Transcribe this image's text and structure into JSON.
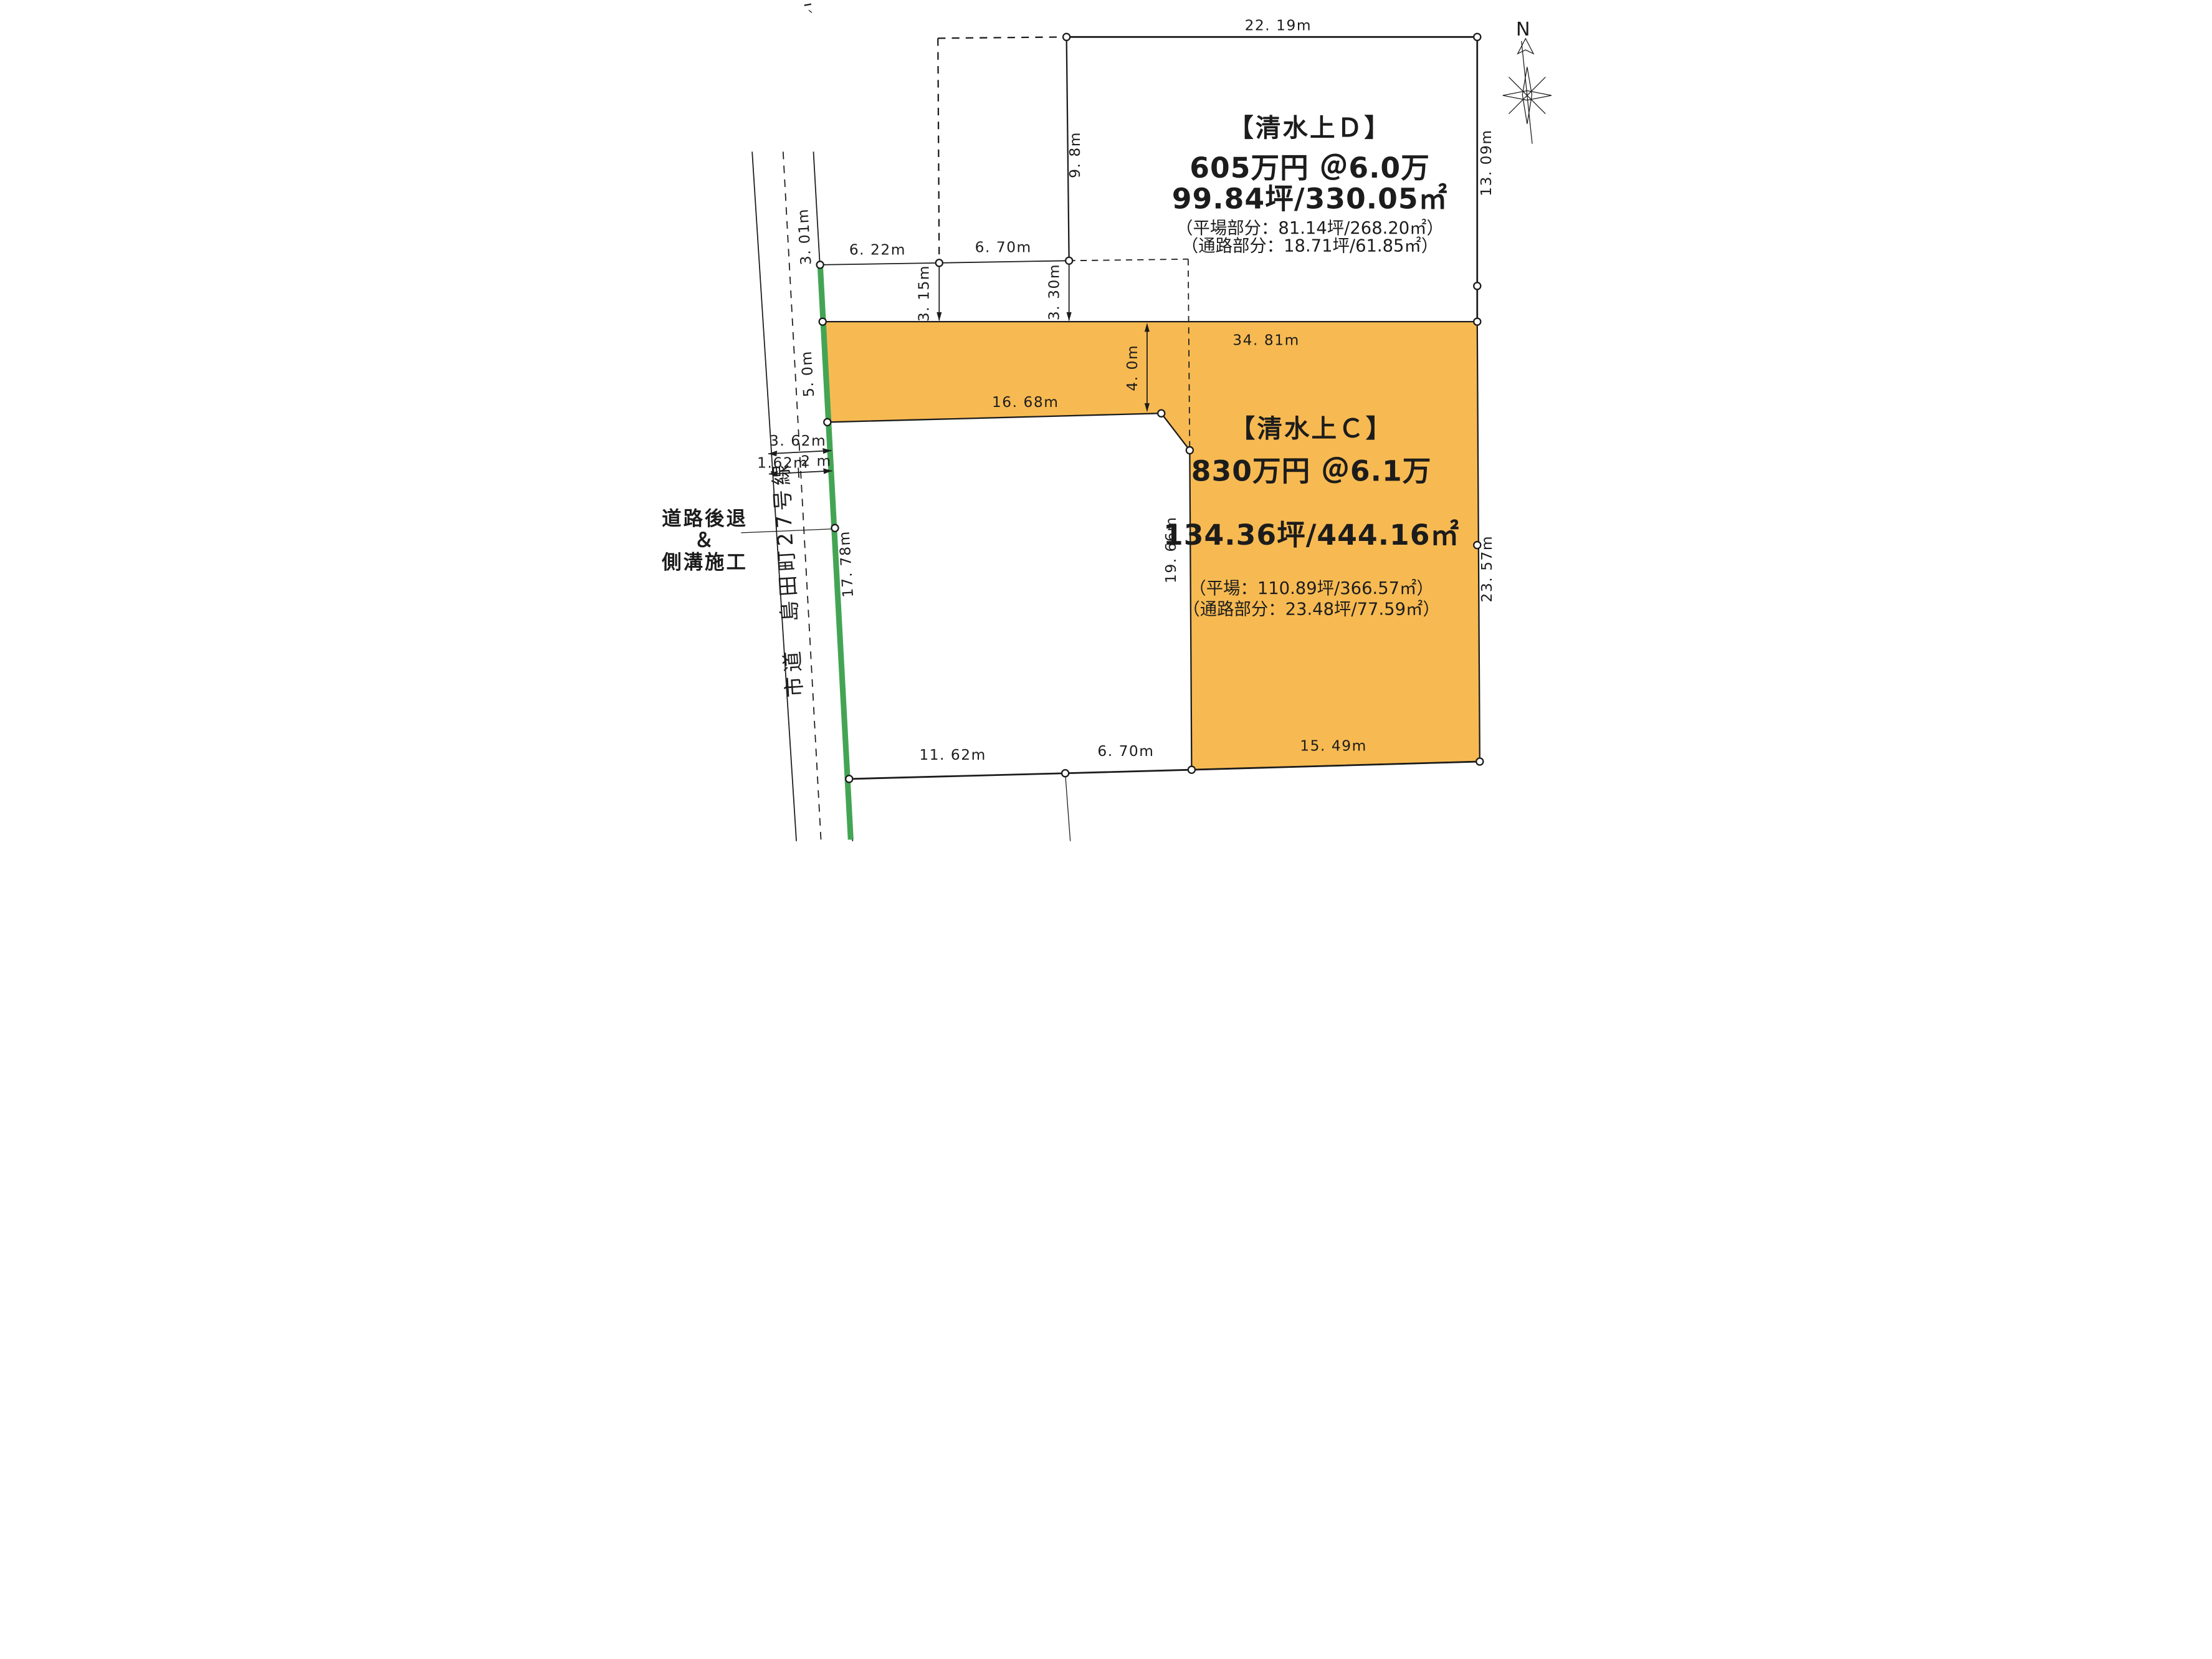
{
  "parcels": {
    "c": {
      "title": "【清水上Ｃ】",
      "price": "830万円 ＠6.1万",
      "area": "134.36坪/444.16㎡",
      "flat": "（平場：110.89坪/366.57㎡）",
      "passage": "（通路部分：23.48坪/77.59㎡）"
    },
    "d": {
      "title": "【清水上Ｄ】",
      "price": "605万円 ＠6.0万",
      "area": "99.84坪/330.05㎡",
      "flat": "（平場部分：81.14坪/268.20㎡）",
      "passage": "（通路部分：18.71坪/61.85㎡）"
    }
  },
  "road": {
    "name": "市道　島田町27号線",
    "setback_line1": "道路後退",
    "setback_line2": "＆",
    "setback_line3": "側溝施工"
  },
  "compass": {
    "north": "N"
  },
  "dims": {
    "top_width": "22. 19m",
    "d_east": "13. 09m",
    "d_west": "9. 8m",
    "front_a": "6. 22m",
    "front_b": "6. 70m",
    "drop_a": "3. 15m",
    "drop_b": "3. 30m",
    "road_a": "3. 01m",
    "road_b": "5. 0m",
    "c_top": "34. 81m",
    "c_inner_top": "16. 68m",
    "corridor_w": "4. 0m",
    "setback_total": "3. 62m",
    "setback_a": "1.62m",
    "setback_b": "2 m",
    "c_front": "17. 78m",
    "c_inner_east": "19. 66m",
    "c_east": "23. 57m",
    "bottom_a": "11. 62m",
    "bottom_b": "6. 70m",
    "bottom_c": "15. 49m"
  },
  "colors": {
    "parcel_fill": "#F7BA52",
    "strip_green": "#43A554",
    "note_green": "#00833E",
    "line": "#1C1C1C"
  }
}
